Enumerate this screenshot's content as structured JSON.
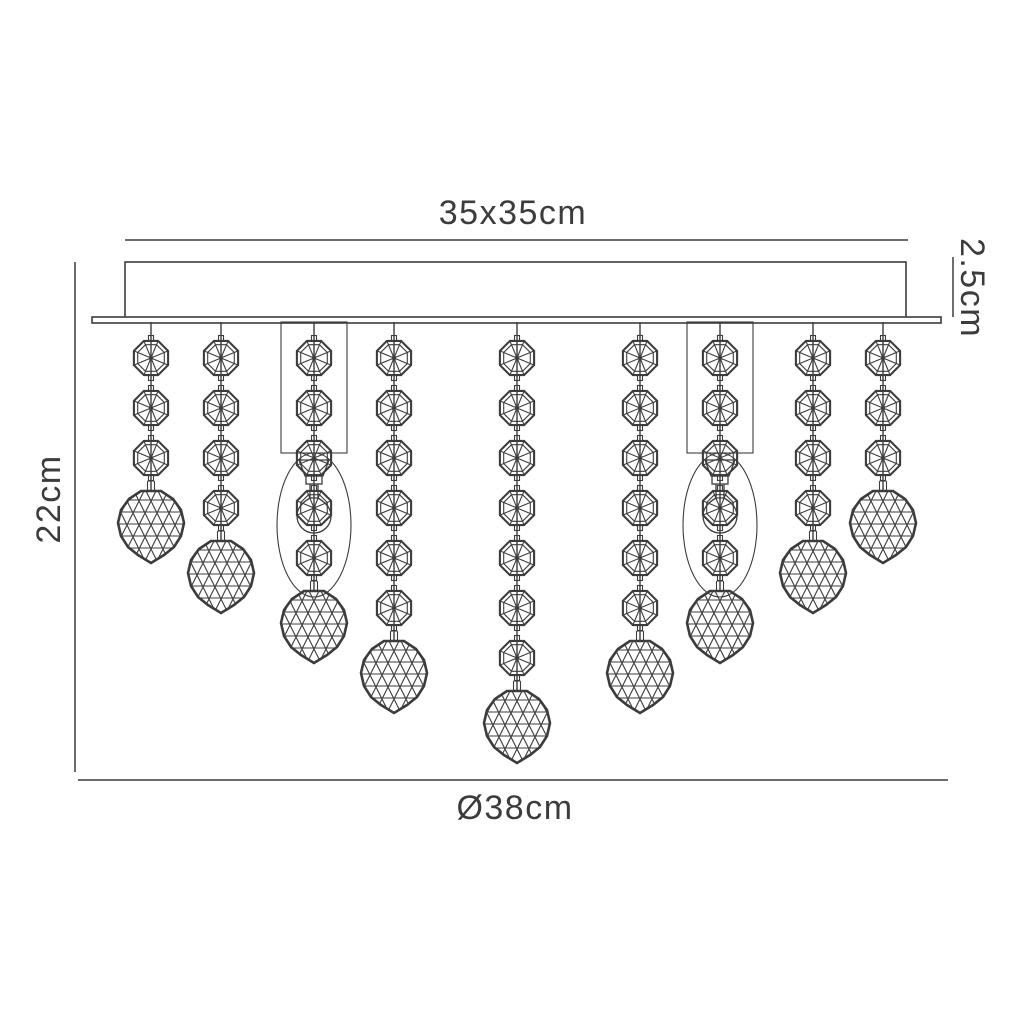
{
  "labels": {
    "top_width": "35x35cm",
    "canopy_depth": "2.5cm",
    "drop_height": "22cm",
    "diameter": "Ø38cm"
  },
  "colors": {
    "line": "#3c3c3c",
    "text": "#3c3c3c",
    "background": "#ffffff"
  },
  "diagram": {
    "type": "technical-line-drawing",
    "canopy": {
      "x": 125,
      "y": 262,
      "w": 781,
      "h": 56
    },
    "plate": {
      "x": 92,
      "y": 317,
      "w": 849,
      "h": 6
    },
    "bead": {
      "first_y": 358,
      "spacing": 50,
      "radius": 18.5
    },
    "ball": {
      "offset": 64
    },
    "strands": [
      {
        "x": 151,
        "beads": 3,
        "lamp": false
      },
      {
        "x": 221,
        "beads": 4,
        "lamp": false
      },
      {
        "x": 314,
        "beads": 5,
        "lamp": true
      },
      {
        "x": 394,
        "beads": 6,
        "lamp": false
      },
      {
        "x": 517,
        "beads": 7,
        "lamp": false
      },
      {
        "x": 640,
        "beads": 6,
        "lamp": false
      },
      {
        "x": 720,
        "beads": 5,
        "lamp": true
      },
      {
        "x": 813,
        "beads": 4,
        "lamp": false
      },
      {
        "x": 883,
        "beads": 3,
        "lamp": false
      }
    ],
    "lamp": {
      "box_w": 66,
      "box_top": 322,
      "box_h": 131,
      "ellipse_cy": 525,
      "ellipse_rx": 37,
      "ellipse_ry": 72,
      "bulb_cy": 516
    },
    "dims": {
      "top": {
        "x1": 125,
        "x2": 908,
        "y": 240,
        "label_x": 513,
        "label_y": 213
      },
      "right": {
        "x": 953,
        "y1": 257,
        "y2": 317,
        "label_x": 972,
        "label_y": 288
      },
      "left": {
        "x": 75,
        "y1": 262,
        "y2": 772,
        "label_x": 49,
        "label_y": 499
      },
      "bottom": {
        "x1": 78,
        "x2": 948,
        "y": 780,
        "label_x": 515,
        "label_y": 808
      }
    }
  }
}
